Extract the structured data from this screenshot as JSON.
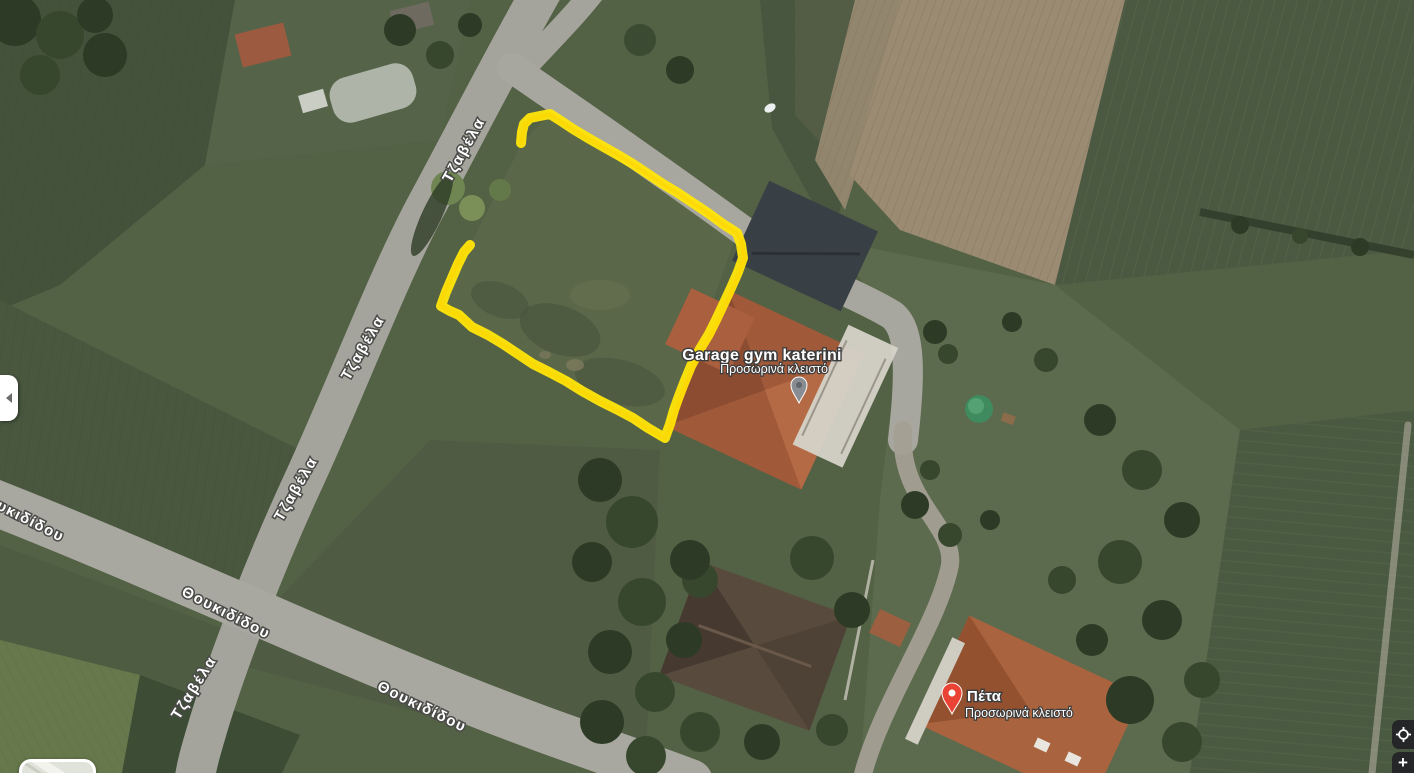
{
  "app": {
    "name": "Satellite map view"
  },
  "map": {
    "streets": [
      {
        "name": "Τζαβέλα"
      },
      {
        "name": "Θουκιδίδου"
      }
    ],
    "pois": [
      {
        "name": "Garage gym katerini",
        "status": "Προσωρινά κλειστό",
        "pin": "gray-pin"
      },
      {
        "name": "Πέτα",
        "status": "Προσωρινά κλειστό",
        "pin": "red-pin"
      }
    ],
    "annotation": {
      "shape": "freehand-plot-outline",
      "color": "#ffe60a"
    }
  },
  "controls": {
    "side_panel_toggle": {
      "icon": "chevron-left-icon"
    },
    "map_preview": {
      "icon": "map-preview-thumbnail"
    },
    "my_location": {
      "icon": "my-location-icon"
    },
    "zoom_in": {
      "label": "+"
    }
  },
  "colors": {
    "annotation_yellow": "#ffe60a",
    "pin_red": "#ea4335",
    "pin_gray": "#878d92",
    "road_gray": "#a5a49c",
    "roof_orange": "#a05a3a",
    "roof_dark": "#383f45",
    "field_green": "#4b5a41",
    "field_tan": "#9a8b72"
  }
}
